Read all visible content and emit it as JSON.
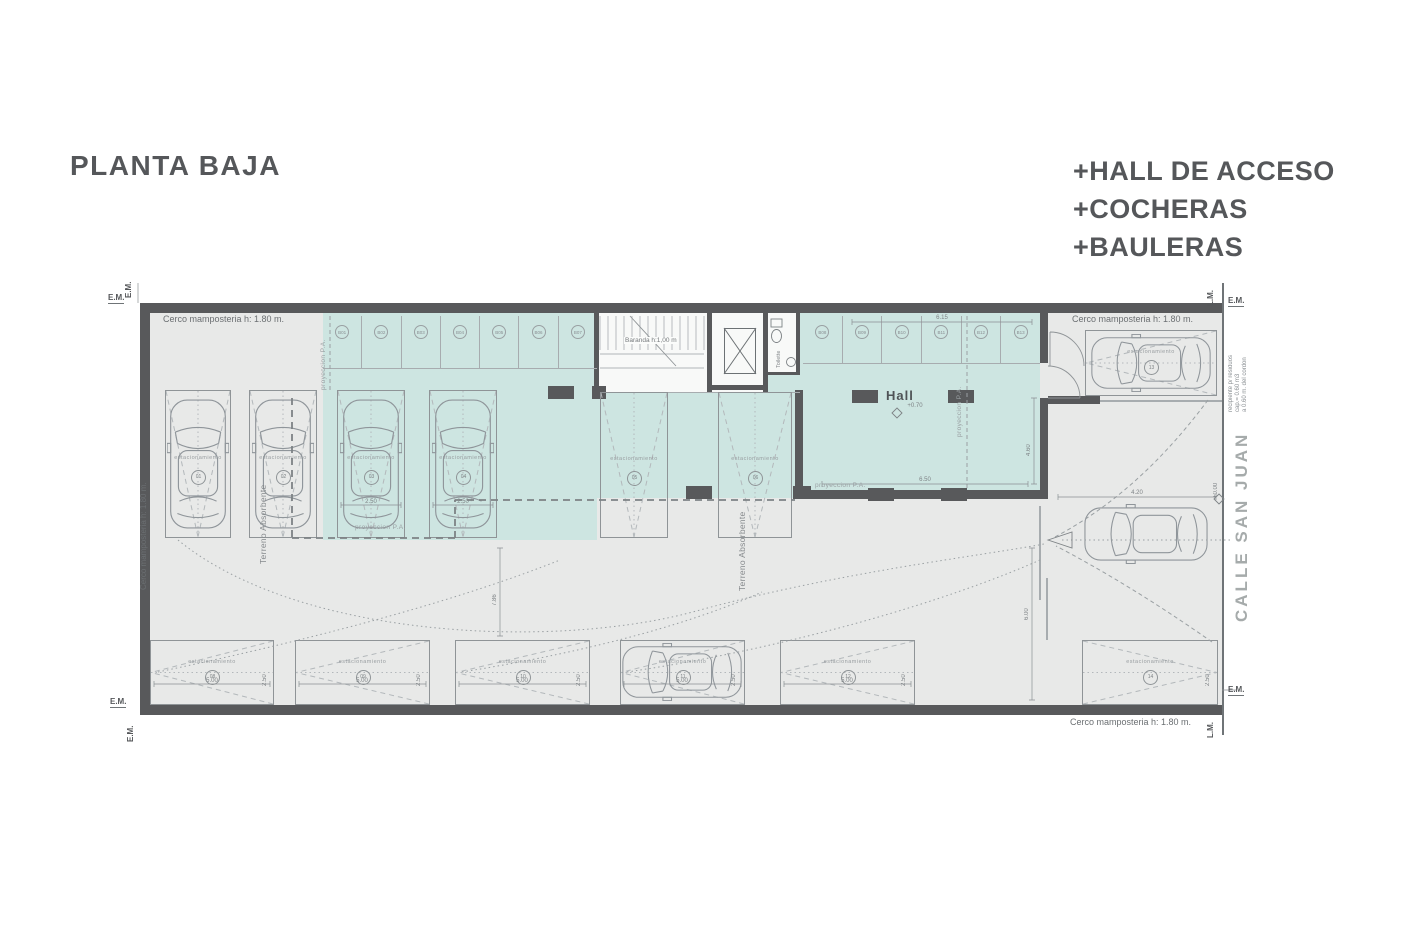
{
  "page": {
    "title": "PLANTA BAJA"
  },
  "program": {
    "items": [
      "+HALL DE ACCESO",
      "+COCHERAS",
      "+BAULERAS"
    ]
  },
  "street": {
    "name": "CALLE SAN JUAN",
    "level": "+0.00"
  },
  "hall": {
    "label": "Hall",
    "level": "+0.70"
  },
  "labels": {
    "fence_top_left": "Cerco mamposteria h: 1.80 m.",
    "fence_left": "Cerco mamposteria h: 1.80 m.",
    "fence_top_right": "Cerco mamposteria  h: 1.80 m.",
    "fence_bottom": "Cerco mamposteria  h: 1.80 m.",
    "terreno_absorbente": "Terreno Absorbente",
    "proyeccion_pa": "proyeccion  P.A.",
    "baranda": "Baranda h:1,00 m",
    "toilette": "Toilette",
    "estacionamiento": "estacionamiento",
    "em": "E.M.",
    "lm": "L.M.",
    "residuos": [
      "recipiente p/ residuos",
      "cap.= 0.60 m3",
      "a 0.60 m. del cordon"
    ]
  },
  "dimensions": {
    "spot_width": "2.50",
    "spot_length": "5.00",
    "bauleras_right_width": "6.15",
    "hall_width": "6.50",
    "hall_depth": "4.60",
    "entry_width": "4.20",
    "gate_depth": "6.00",
    "drive_depth": "7.86"
  },
  "bauleras": {
    "left": [
      "B01",
      "B02",
      "B03",
      "B04",
      "B05",
      "B06",
      "B07"
    ],
    "right": [
      "B08",
      "B09",
      "B10",
      "B11",
      "B12",
      "B13"
    ]
  },
  "parking_spots": [
    {
      "id": "01"
    },
    {
      "id": "02"
    },
    {
      "id": "03"
    },
    {
      "id": "04"
    },
    {
      "id": "05"
    },
    {
      "id": "06"
    },
    {
      "id": "08"
    },
    {
      "id": "09"
    },
    {
      "id": "10"
    },
    {
      "id": "11"
    },
    {
      "id": "12"
    },
    {
      "id": "13"
    },
    {
      "id": "14"
    }
  ]
}
